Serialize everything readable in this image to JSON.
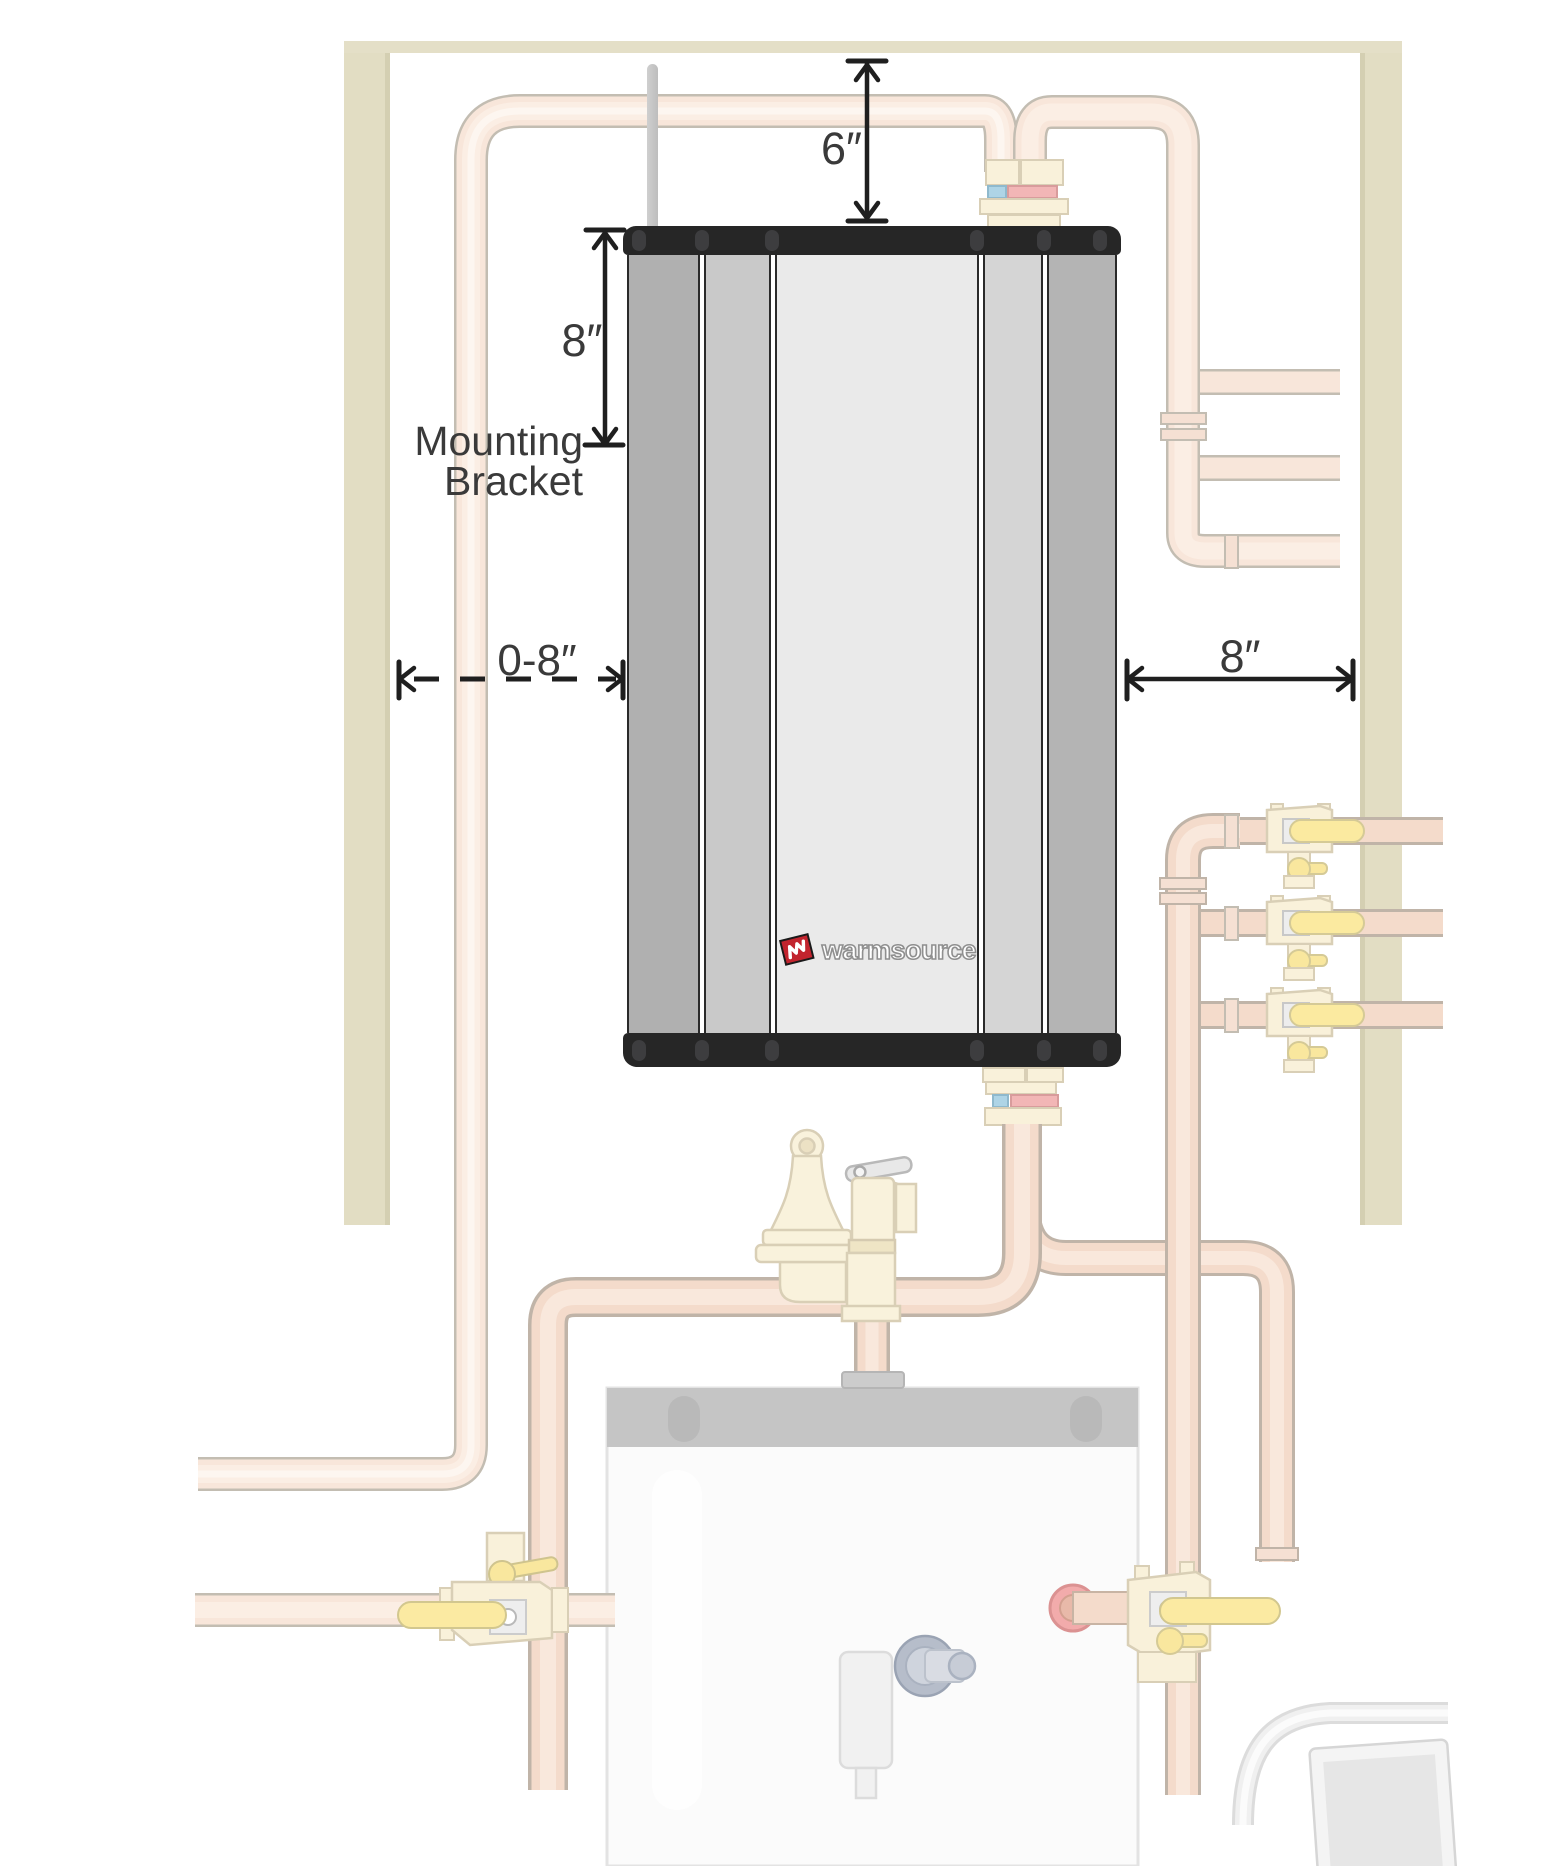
{
  "page": {
    "description": "Tankless water heater wall-clearance installation diagram"
  },
  "unit": {
    "brand": "warmsource"
  },
  "dimensions": {
    "top_clearance": {
      "label": "6″"
    },
    "bracket_height": {
      "label": "8″"
    },
    "bracket_caption_line1": "Mounting",
    "bracket_caption_line2": "Bracket",
    "left_clearance": {
      "label": "0-8″"
    },
    "right_clearance": {
      "label": "8″"
    }
  },
  "colors": {
    "wall_stud": "#e2ddc3",
    "pipe_fill": "#f8e6da",
    "pipe_outline": "#c3bdb2",
    "copper_fill": "#f4dbcb",
    "brass_fill": "#f9f1da",
    "brass_outline": "#d9cfb6",
    "handle_yellow": "#fbeaa0",
    "stripe_red": "#f2b6b6",
    "stripe_blue": "#aed4e6",
    "unit_cap": "#262626",
    "panel_grays": [
      "#b0b0b0",
      "#c9c9c9",
      "#eaeaea",
      "#d5d5d5",
      "#b4b4b4"
    ],
    "logo_red": "#c2242e",
    "dimension_ink": "#1f1f1f",
    "tank_band": "#c5c5c5"
  }
}
